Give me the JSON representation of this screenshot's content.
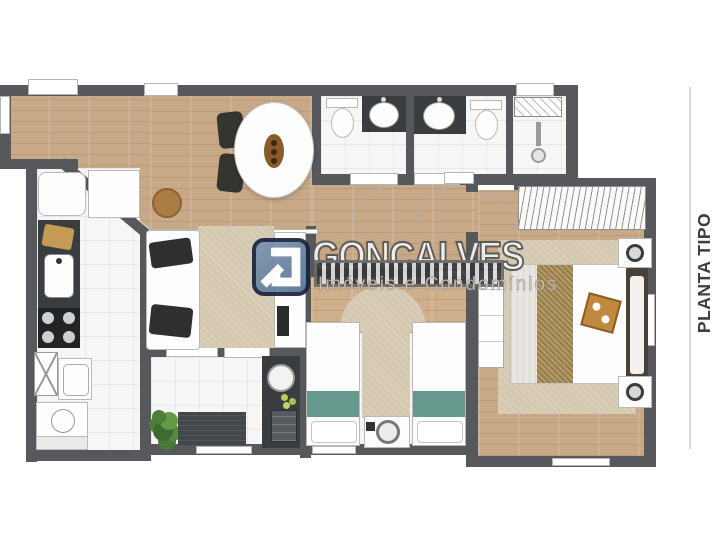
{
  "watermark": {
    "brand": "GONÇALVES",
    "subtitle": "Imóveis e Condomínios",
    "logo_color": "#6884a3",
    "logo_border": "#16233f"
  },
  "side_label": {
    "text": "PLANTA TIPO",
    "color": "#3e3e3e"
  },
  "palette": {
    "wall": "#56585c",
    "wood_floor": "#c7a887",
    "tile_floor": "#f6f6f7",
    "rug": "#d9cdb6",
    "teal_bedding": "#67988d",
    "dark_counter": "#3a3d3f",
    "plant_green": "#4e7d3c"
  }
}
